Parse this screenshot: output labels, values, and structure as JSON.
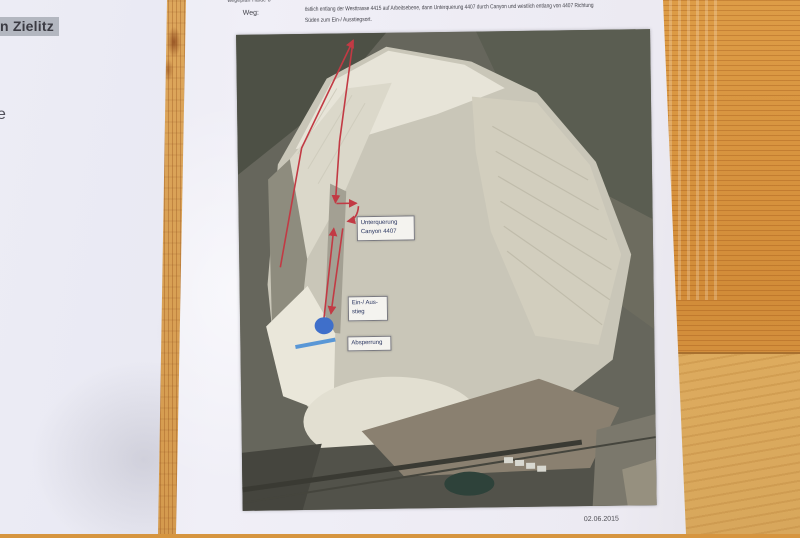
{
  "left_document": {
    "highlight_text": "n Zielitz",
    "edge_fragment": "e",
    "para1": [
      "Ausschluss der",
      "Schäden und",
      "erkannt.  Mit",
      "eldung erklärt",
      "diesen  Lauf",
      "n  körperlich",
      "durch  höhere",
      "e  Sturm  und",
      "ruch  auf  die",
      "en."
    ],
    "para2": [
      "n der Presse,",
      "n meinerseits",
      "n."
    ]
  },
  "right_document": {
    "top_fragment": "wegeplan Halde 8",
    "weg_label": "Weg:",
    "weg_line1": "östlich entlang der Westtrasse 4415 auf Arbeitsebene, dann Unterquerung 4407 durch Canyon und westlich entlang von 4407 Richtung",
    "weg_line2": "Süden zum Ein-/ Ausstiegsort.",
    "date": "02.06.2015",
    "map_labels": {
      "underpass_line1": "Unterquerung",
      "underpass_line2": "Canyon 4407",
      "entry_line1": "Ein-/ Aus-",
      "entry_line2": "stieg",
      "barrier": "Absperrung"
    }
  },
  "colors": {
    "annotation_red": "#c23a44",
    "entry_marker_blue": "#3f6fca",
    "barrier_blue": "#4a8fd6",
    "highlight_gray": "#b3b7c0",
    "wood": "#d6953f"
  }
}
